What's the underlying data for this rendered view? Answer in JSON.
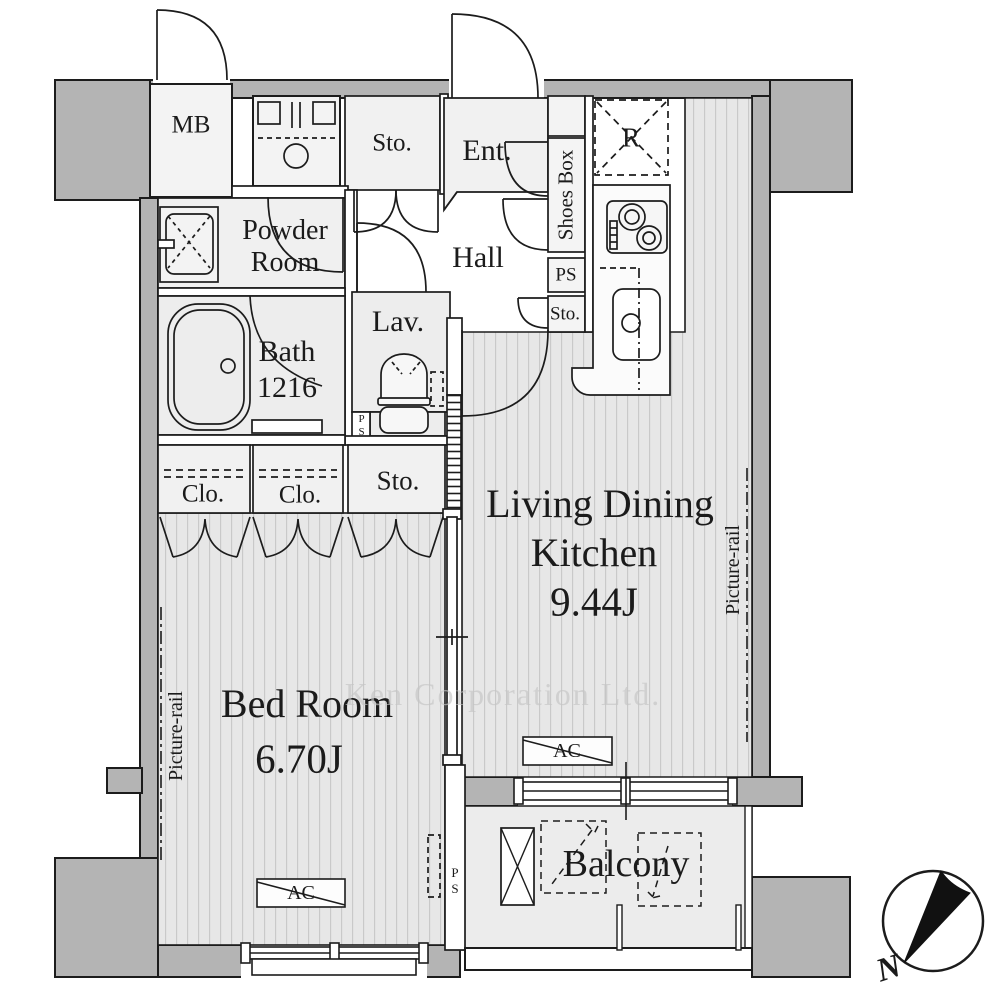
{
  "rooms": {
    "mb": "MB",
    "storage_top": "Sto.",
    "entrance": "Ent.",
    "hall": "Hall",
    "powder_line1": "Powder",
    "powder_line2": "Room",
    "bath": "Bath",
    "bath_size": "1216",
    "lavatory": "Lav.",
    "shoes_box": "Shoes Box",
    "pipe_space_upper": "PS",
    "storage_mid": "Sto.",
    "refrigerator": "R",
    "closet1": "Clo.",
    "closet2": "Clo.",
    "storage_bottom": "Sto.",
    "pipe_space_lavatory": "PS",
    "ldk_line1": "Living Dining",
    "ldk_line2": "Kitchen",
    "ldk_size": "9.44J",
    "bedroom": "Bed Room",
    "bedroom_size": "6.70J",
    "balcony": "Balcony",
    "pipe_space_balcony": "PS"
  },
  "annotations": {
    "picture_rail_left": "Picture-rail",
    "picture_rail_right": "Picture-rail",
    "ac_ldk": "AC",
    "ac_bedroom": "AC",
    "compass_north": "N",
    "watermark": "Ken Corporation Ltd."
  },
  "colors": {
    "wall_gray": "#b4b4b4",
    "floor_stripe_bg": "#e7e7e7",
    "floor_stripe_line": "#c9c9c9",
    "room_light": "#f1f1f1",
    "balcony_floor": "#ececec",
    "line": "#1c1c1c",
    "watermark_gray": "#c5c5c5"
  }
}
